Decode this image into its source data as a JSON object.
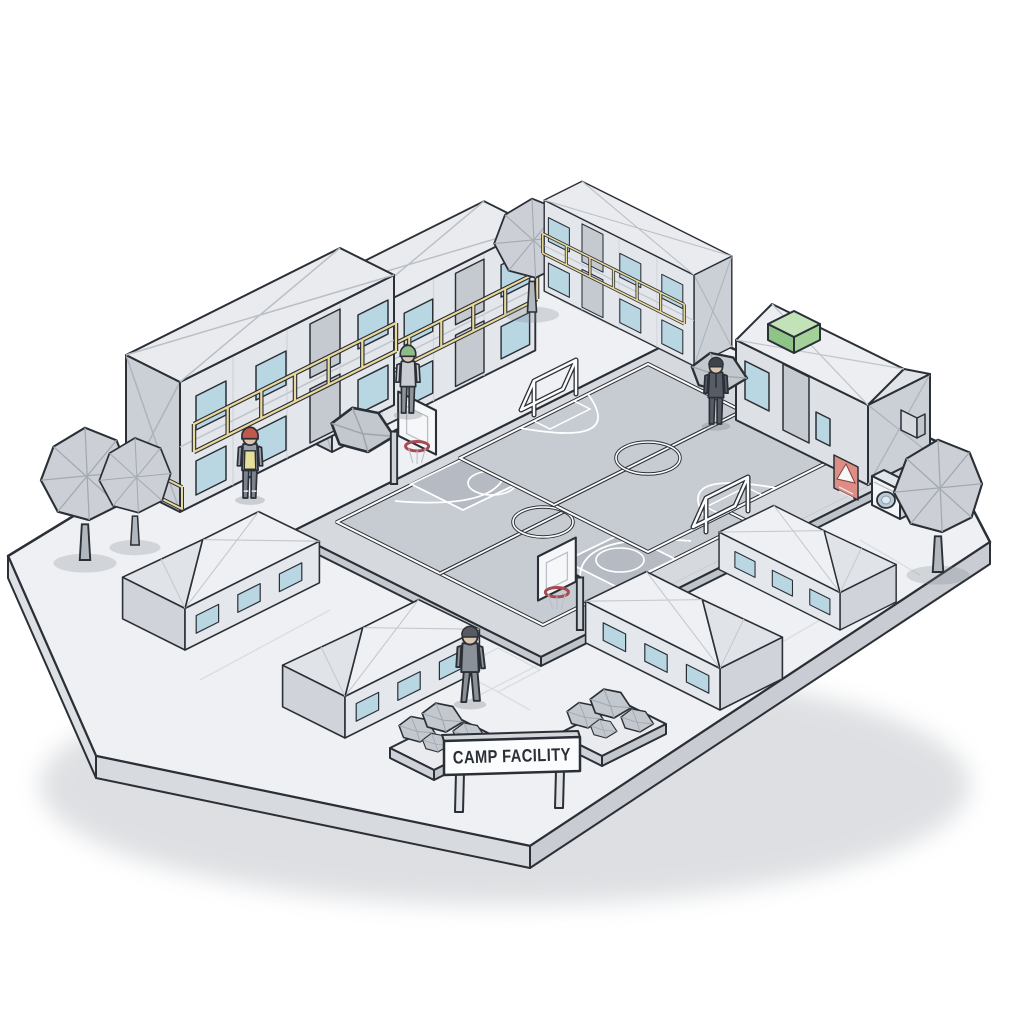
{
  "sign": {
    "label": "CAMP FACILITY"
  },
  "scene": {
    "description": "Isometric low-poly illustration of a camp facility on a floating gray platform",
    "background_color": "#ffffff"
  },
  "palette": {
    "outline": "#2b2f36",
    "platform_top": "#eef0f3",
    "platform_side": "#d2d5da",
    "court_surface": "#c7cbd2",
    "court_key_paint": "#b6bbc3",
    "court_line": "#ffffff",
    "building_wall": "#e3e6ea",
    "building_side": "#cbcfd6",
    "roof": "#e9ebef",
    "window_glass": "#b9d6e3",
    "railing_yellow": "#ead99c",
    "hvac_green": "#a9d49e",
    "warning_red": "#dc8d85",
    "hoop_rim_red": "#a84a52",
    "vest_yellow": "#e7e09a",
    "helmet_red": "#c2574c",
    "helmet_green": "#8fbb88",
    "tree_gray": "#ccd0d6",
    "suit_dark": "#575c65",
    "suit_gray": "#8b9199"
  },
  "inventory": {
    "container_dorms": [
      {
        "id": "northwest",
        "stories": 2,
        "balcony_railing": "yellow",
        "windows": "blue"
      },
      {
        "id": "north",
        "stories": 2,
        "balcony_railing": "yellow",
        "windows": "blue"
      },
      {
        "id": "northeast",
        "stories": 2,
        "balcony_railing": "yellow",
        "windows": "blue"
      }
    ],
    "utility_building": {
      "features": [
        "green rooftop unit",
        "warning placard",
        "washing machine",
        "door",
        "window",
        "small window",
        "wall box"
      ]
    },
    "tents": [
      {
        "id": "west"
      },
      {
        "id": "southwest"
      },
      {
        "id": "southeast"
      },
      {
        "id": "east"
      }
    ],
    "courts": [
      {
        "type": "basketball",
        "hoops": 2,
        "markings": [
          "boundary",
          "center line",
          "center circle",
          "keys",
          "three-point arcs"
        ]
      },
      {
        "type": "soccer",
        "goals": 2,
        "markings": [
          "boundary",
          "center line",
          "center circle",
          "penalty arcs",
          "goal boxes"
        ]
      }
    ],
    "trees": 4,
    "boulders": 2,
    "rock_planters": 2,
    "people": [
      {
        "id": "worker-red-helmet",
        "outfit": "yellow safety vest, red hard hat"
      },
      {
        "id": "worker-green-helmet",
        "outfit": "light work clothes, green hard hat"
      },
      {
        "id": "visitor-dark-suit",
        "outfit": "dark suit"
      },
      {
        "id": "visitor-gray-suit",
        "outfit": "gray suit"
      }
    ]
  }
}
